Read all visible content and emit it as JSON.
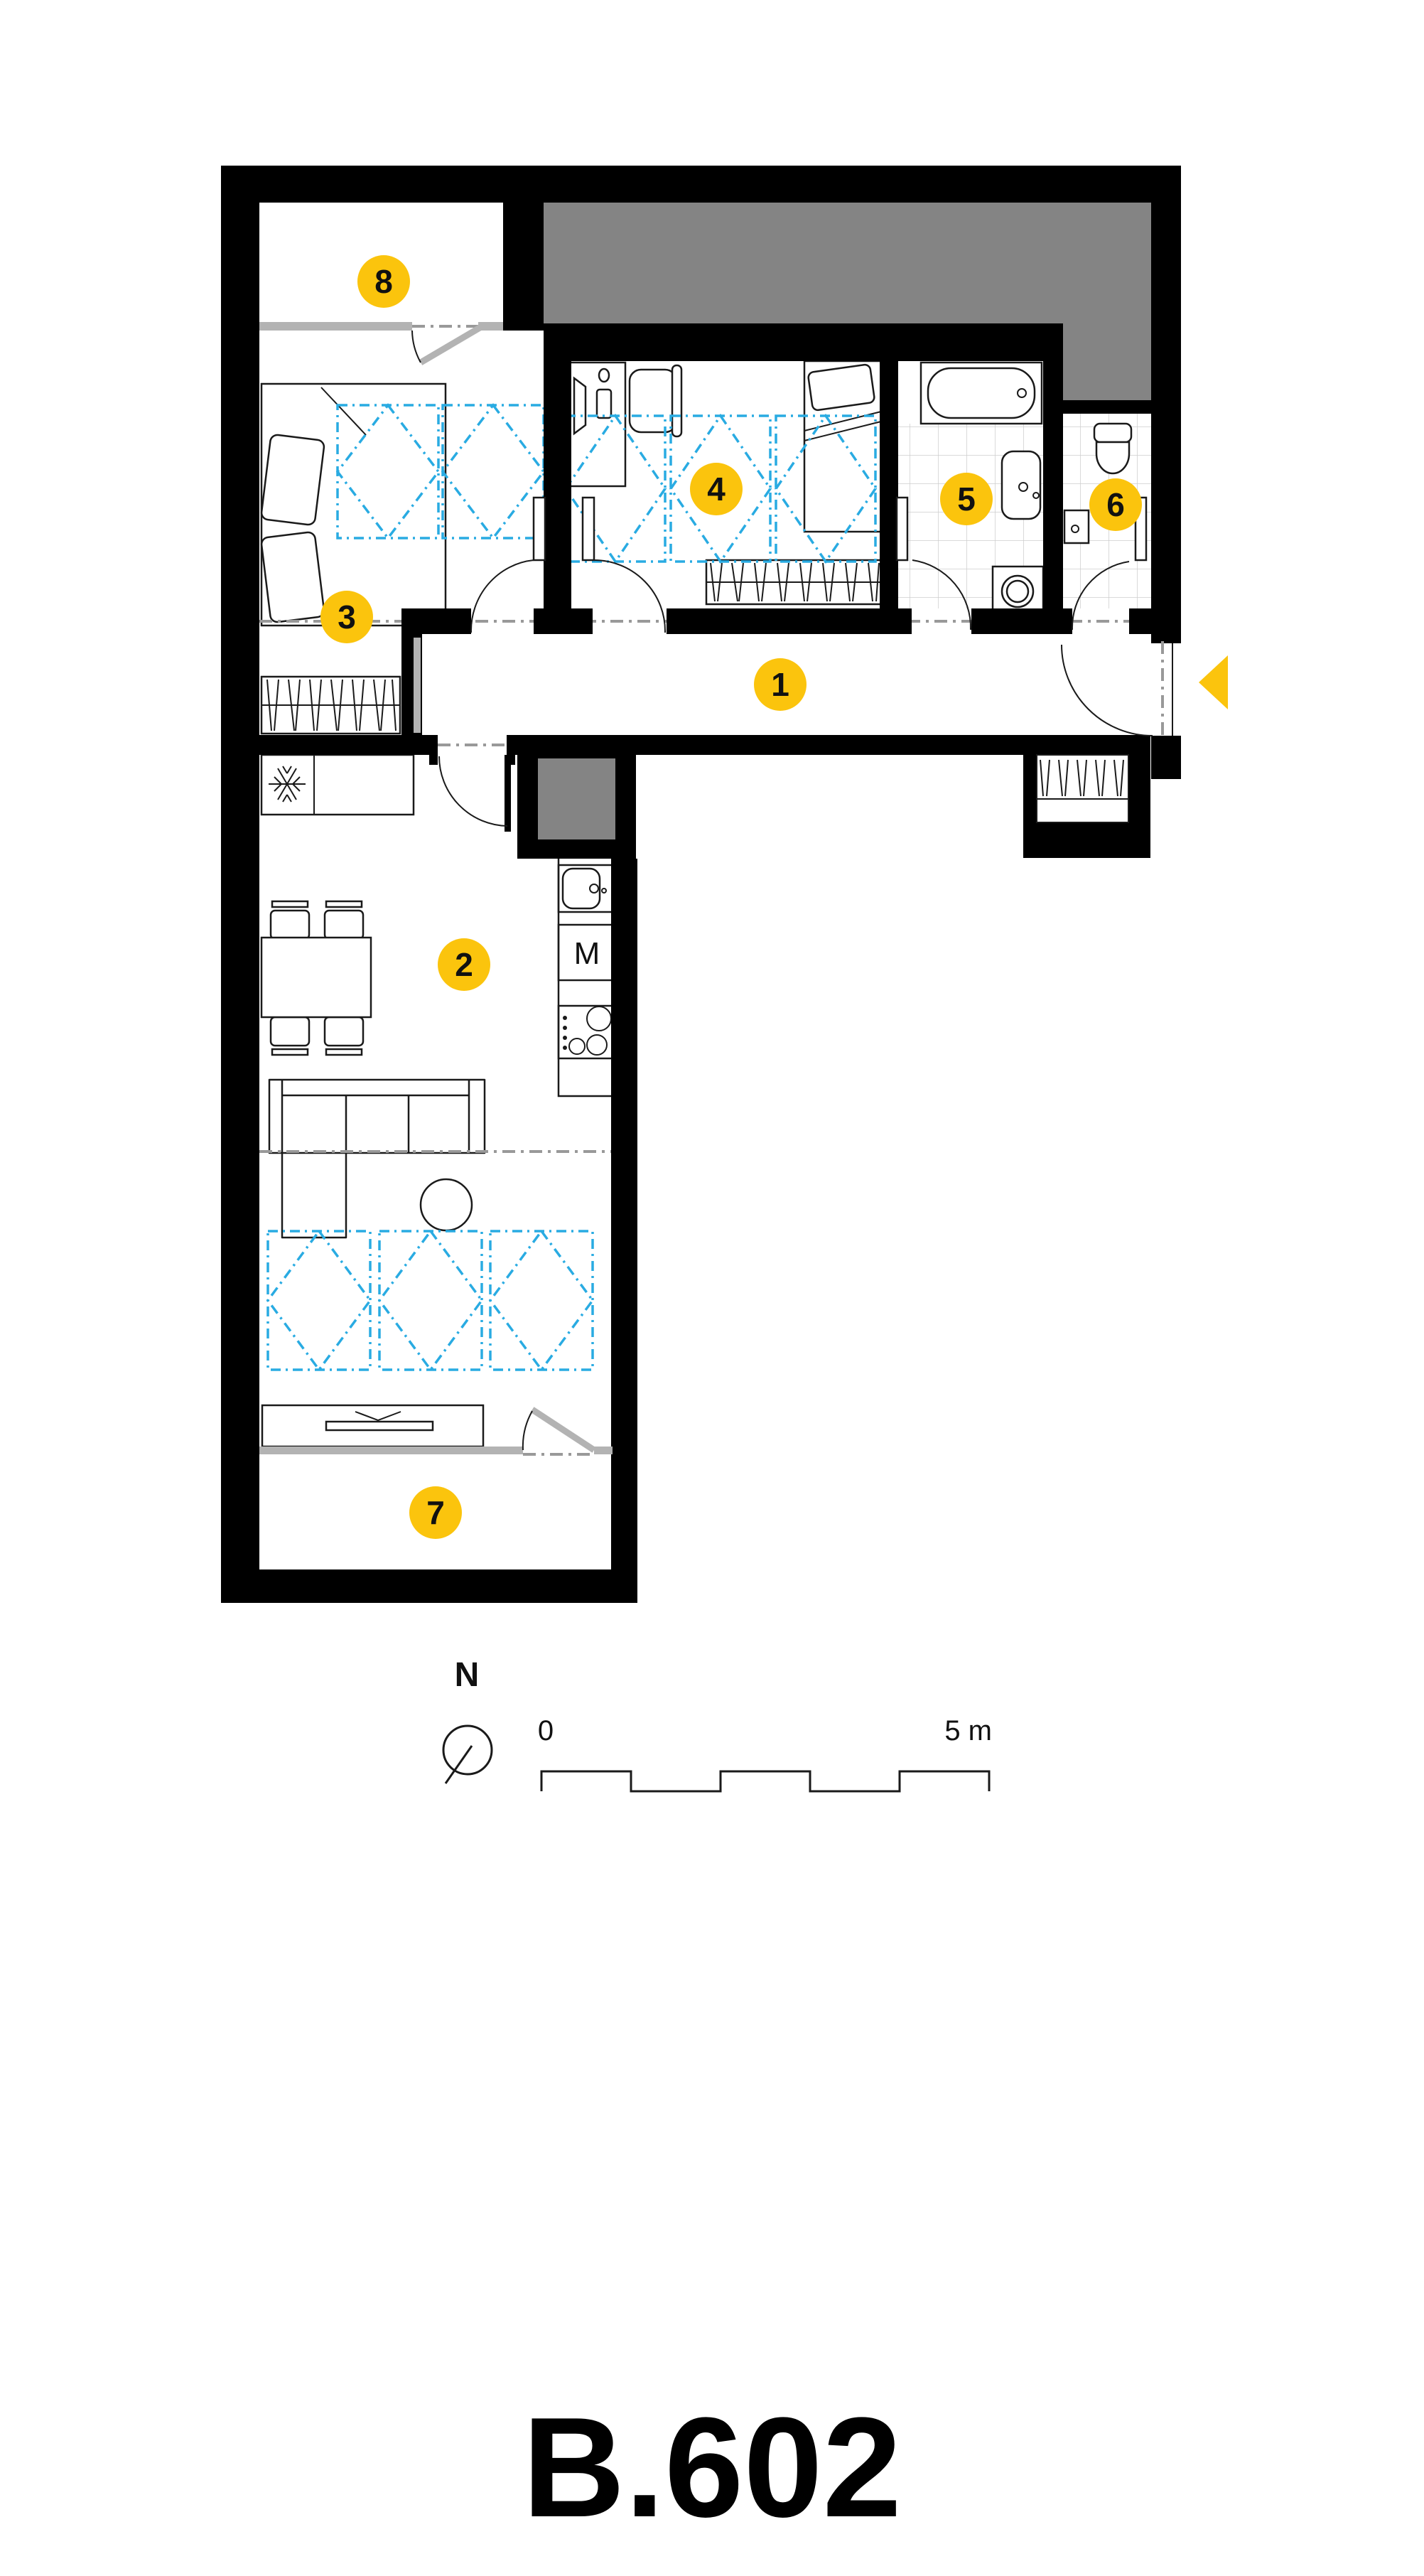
{
  "title": "B.602",
  "markers": [
    {
      "number": "1"
    },
    {
      "number": "2"
    },
    {
      "number": "3"
    },
    {
      "number": "4"
    },
    {
      "number": "5"
    },
    {
      "number": "6"
    },
    {
      "number": "7"
    },
    {
      "number": "8"
    }
  ],
  "compass": {
    "label": "N"
  },
  "scalebar": {
    "start_label": "0",
    "end_label": "5 m"
  },
  "kitchen": {
    "appliance_label": "M"
  },
  "colors": {
    "marker_yellow": "#FBC40D",
    "ceiling_zone_blue": "#29ABE2",
    "adjacent_area_gray": "#848484",
    "glazing_gray": "#B3B3B3",
    "wall_black": "#000000"
  }
}
